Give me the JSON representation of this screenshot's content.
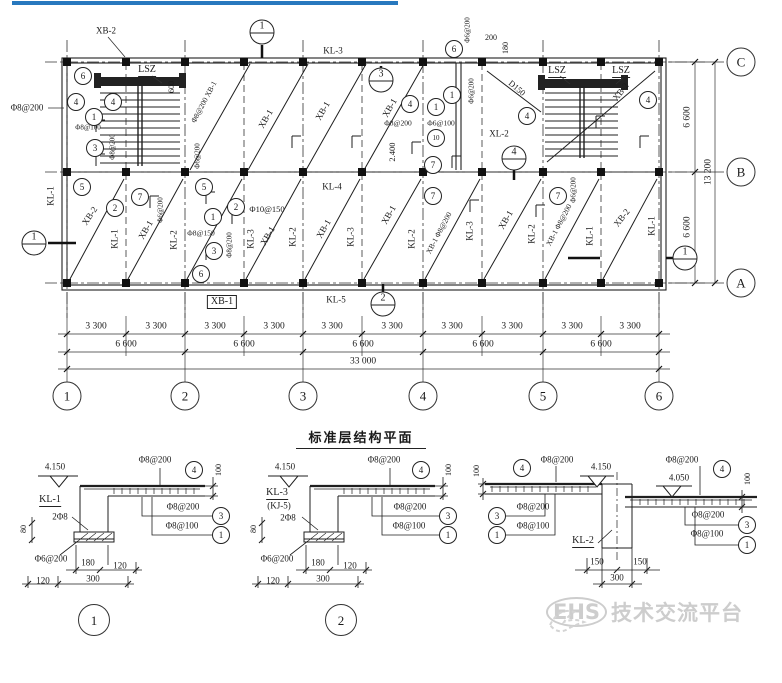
{
  "page": {
    "accent_bar_color": "#2878be",
    "background": "#ffffff"
  },
  "title": {
    "text": "标准层结构平面"
  },
  "watermark": {
    "icon": "dove-icon",
    "brand": "EHS",
    "text": "技术交流平台"
  },
  "labels": [
    {
      "t": "XB-2",
      "x": 106,
      "y": 31
    },
    {
      "t": "KL-3",
      "x": 333,
      "y": 51
    },
    {
      "t": "LSZ",
      "x": 147,
      "y": 71,
      "k": "u"
    },
    {
      "t": "600",
      "x": 172,
      "y": 87,
      "k": "v",
      "fs": 8
    },
    {
      "t": "Φ8@200",
      "x": 27,
      "y": 108
    },
    {
      "t": "Φ8@100",
      "x": 88,
      "y": 128,
      "fs": 7
    },
    {
      "t": "Φ8@200",
      "x": 113,
      "y": 147,
      "k": "v",
      "fs": 7
    },
    {
      "t": "Φ8@200 XB-1",
      "x": 204,
      "y": 102,
      "r": -62,
      "fs": 7.5
    },
    {
      "t": "Φ6@200",
      "x": 198,
      "y": 156,
      "k": "v",
      "fs": 7
    },
    {
      "t": "XB-1",
      "x": 266,
      "y": 119,
      "r": -60
    },
    {
      "t": "XB-1",
      "x": 323,
      "y": 111,
      "r": -60
    },
    {
      "t": "XB-1",
      "x": 390,
      "y": 108,
      "r": -60
    },
    {
      "t": "Φ6@200",
      "x": 468,
      "y": 30,
      "k": "v",
      "fs": 7
    },
    {
      "t": "200",
      "x": 491,
      "y": 38,
      "fs": 8
    },
    {
      "t": "180",
      "x": 506,
      "y": 48,
      "k": "v",
      "fs": 8
    },
    {
      "t": "Φ6@200",
      "x": 472,
      "y": 91,
      "k": "v",
      "fs": 7
    },
    {
      "t": "D150",
      "x": 517,
      "y": 88,
      "r": 40,
      "fs": 8.5
    },
    {
      "t": "LSZ",
      "x": 557,
      "y": 72,
      "k": "u"
    },
    {
      "t": "LSZ",
      "x": 621,
      "y": 72,
      "k": "u"
    },
    {
      "t": "XB-2",
      "x": 621,
      "y": 92,
      "r": -52
    },
    {
      "t": "Φ8@200",
      "x": 398,
      "y": 123,
      "fs": 7.5
    },
    {
      "t": "Φ6@100",
      "x": 441,
      "y": 123,
      "fs": 7.5
    },
    {
      "t": "XL-2",
      "x": 499,
      "y": 134
    },
    {
      "t": "2.400",
      "x": 392,
      "y": 152,
      "k": "v",
      "fs": 8.5
    },
    {
      "t": "KL-4",
      "x": 332,
      "y": 187
    },
    {
      "t": "KL-1",
      "x": 51,
      "y": 196,
      "k": "v"
    },
    {
      "t": "XB-2",
      "x": 90,
      "y": 216,
      "r": -56
    },
    {
      "t": "KL-1",
      "x": 115,
      "y": 239,
      "k": "v"
    },
    {
      "t": "XB-1",
      "x": 146,
      "y": 230,
      "r": -60
    },
    {
      "t": "Φ6@200",
      "x": 161,
      "y": 210,
      "k": "v",
      "fs": 7
    },
    {
      "t": "KL-2",
      "x": 174,
      "y": 240,
      "k": "v"
    },
    {
      "t": "Φ8@150",
      "x": 201,
      "y": 233,
      "fs": 7.5
    },
    {
      "t": "Φ8@200",
      "x": 230,
      "y": 245,
      "k": "v",
      "fs": 7
    },
    {
      "t": "Φ10@150",
      "x": 267,
      "y": 209,
      "fs": 8.5
    },
    {
      "t": "KL-3",
      "x": 251,
      "y": 239,
      "k": "v"
    },
    {
      "t": "XB-1",
      "x": 268,
      "y": 236,
      "r": -60
    },
    {
      "t": "KL-2",
      "x": 293,
      "y": 237,
      "k": "v"
    },
    {
      "t": "XB-1",
      "x": 324,
      "y": 229,
      "r": -60
    },
    {
      "t": "KL-3",
      "x": 351,
      "y": 237,
      "k": "v"
    },
    {
      "t": "XB-1",
      "x": 389,
      "y": 215,
      "r": -60
    },
    {
      "t": "KL-2",
      "x": 412,
      "y": 239,
      "k": "v"
    },
    {
      "t": "XB-1 Φ8@200",
      "x": 439,
      "y": 233,
      "r": -62,
      "fs": 7.5
    },
    {
      "t": "KL-3",
      "x": 470,
      "y": 231,
      "k": "v"
    },
    {
      "t": "XB-1",
      "x": 506,
      "y": 220,
      "r": -60
    },
    {
      "t": "KL-2",
      "x": 532,
      "y": 234,
      "k": "v"
    },
    {
      "t": "XB-1 Φ8@200",
      "x": 559,
      "y": 225,
      "r": -62,
      "fs": 7.5
    },
    {
      "t": "Φ6@200",
      "x": 574,
      "y": 190,
      "k": "v",
      "fs": 7
    },
    {
      "t": "KL-1",
      "x": 590,
      "y": 236,
      "k": "v"
    },
    {
      "t": "XB-2",
      "x": 622,
      "y": 218,
      "r": -52
    },
    {
      "t": "KL-1",
      "x": 652,
      "y": 226,
      "k": "v"
    },
    {
      "t": "KL-5",
      "x": 336,
      "y": 300
    },
    {
      "t": "XB-1",
      "x": 222,
      "y": 302,
      "k": "b"
    },
    {
      "t": "6",
      "x": 83,
      "y": 76,
      "k": "c"
    },
    {
      "t": "4",
      "x": 76,
      "y": 102,
      "k": "c"
    },
    {
      "t": "4",
      "x": 113,
      "y": 102,
      "k": "c"
    },
    {
      "t": "1",
      "x": 94,
      "y": 117,
      "k": "c"
    },
    {
      "t": "3",
      "x": 95,
      "y": 148,
      "k": "c"
    },
    {
      "t": "5",
      "x": 82,
      "y": 187,
      "k": "c"
    },
    {
      "t": "7",
      "x": 140,
      "y": 197,
      "k": "c"
    },
    {
      "t": "2",
      "x": 115,
      "y": 208,
      "k": "c"
    },
    {
      "t": "5",
      "x": 204,
      "y": 187,
      "k": "c"
    },
    {
      "t": "1",
      "x": 213,
      "y": 217,
      "k": "c"
    },
    {
      "t": "2",
      "x": 236,
      "y": 207,
      "k": "c"
    },
    {
      "t": "3",
      "x": 214,
      "y": 251,
      "k": "c"
    },
    {
      "t": "6",
      "x": 201,
      "y": 274,
      "k": "c"
    },
    {
      "t": "7",
      "x": 433,
      "y": 165,
      "k": "c"
    },
    {
      "t": "7",
      "x": 433,
      "y": 196,
      "k": "c"
    },
    {
      "t": "4",
      "x": 410,
      "y": 104,
      "k": "c"
    },
    {
      "t": "1",
      "x": 436,
      "y": 107,
      "k": "c"
    },
    {
      "t": "10",
      "x": 436,
      "y": 138,
      "k": "c",
      "fs": 7
    },
    {
      "t": "6",
      "x": 454,
      "y": 49,
      "k": "c"
    },
    {
      "t": "1",
      "x": 452,
      "y": 95,
      "k": "c"
    },
    {
      "t": "4",
      "x": 527,
      "y": 116,
      "k": "c"
    },
    {
      "t": "4",
      "x": 648,
      "y": 100,
      "k": "c"
    },
    {
      "t": "7",
      "x": 558,
      "y": 196,
      "k": "c"
    },
    {
      "t": "1",
      "x": 262,
      "y": 32,
      "k": "s"
    },
    {
      "t": "3",
      "x": 381,
      "y": 80,
      "k": "s"
    },
    {
      "t": "4",
      "x": 514,
      "y": 158,
      "k": "s"
    },
    {
      "t": "2",
      "x": 383,
      "y": 304,
      "k": "s"
    },
    {
      "t": "1",
      "x": 34,
      "y": 243,
      "k": "s"
    },
    {
      "t": "1",
      "x": 685,
      "y": 258,
      "k": "s"
    },
    {
      "t": "3 300",
      "x": 96,
      "y": 327,
      "fs": 9.5
    },
    {
      "t": "3 300",
      "x": 156,
      "y": 327,
      "fs": 9.5
    },
    {
      "t": "3 300",
      "x": 215,
      "y": 327,
      "fs": 9.5
    },
    {
      "t": "3 300",
      "x": 274,
      "y": 327,
      "fs": 9.5
    },
    {
      "t": "3 300",
      "x": 332,
      "y": 327,
      "fs": 9.5
    },
    {
      "t": "3 300",
      "x": 392,
      "y": 327,
      "fs": 9.5
    },
    {
      "t": "3 300",
      "x": 452,
      "y": 327,
      "fs": 9.5
    },
    {
      "t": "3 300",
      "x": 512,
      "y": 327,
      "fs": 9.5
    },
    {
      "t": "3 300",
      "x": 572,
      "y": 327,
      "fs": 9.5
    },
    {
      "t": "3 300",
      "x": 630,
      "y": 327,
      "fs": 9.5
    },
    {
      "t": "6 600",
      "x": 126,
      "y": 345,
      "fs": 9.5
    },
    {
      "t": "6 600",
      "x": 244,
      "y": 345,
      "fs": 9.5
    },
    {
      "t": "6 600",
      "x": 363,
      "y": 345,
      "fs": 9.5
    },
    {
      "t": "6 600",
      "x": 483,
      "y": 345,
      "fs": 9.5
    },
    {
      "t": "6 600",
      "x": 601,
      "y": 345,
      "fs": 9.5
    },
    {
      "t": "33 000",
      "x": 363,
      "y": 362,
      "fs": 9.5
    },
    {
      "t": "6 600",
      "x": 688,
      "y": 117,
      "k": "v",
      "fs": 9.5
    },
    {
      "t": "13 200",
      "x": 709,
      "y": 172,
      "k": "v",
      "fs": 9.5
    },
    {
      "t": "6 600",
      "x": 688,
      "y": 227,
      "k": "v",
      "fs": 9.5
    },
    {
      "t": "1",
      "x": 67,
      "y": 396,
      "k": "C"
    },
    {
      "t": "2",
      "x": 185,
      "y": 396,
      "k": "C"
    },
    {
      "t": "3",
      "x": 303,
      "y": 396,
      "k": "C"
    },
    {
      "t": "4",
      "x": 423,
      "y": 396,
      "k": "C"
    },
    {
      "t": "5",
      "x": 543,
      "y": 396,
      "k": "C"
    },
    {
      "t": "6",
      "x": 659,
      "y": 396,
      "k": "C"
    },
    {
      "t": "C",
      "x": 741,
      "y": 62,
      "k": "C"
    },
    {
      "t": "B",
      "x": 741,
      "y": 172,
      "k": "C"
    },
    {
      "t": "A",
      "x": 741,
      "y": 283,
      "k": "C"
    },
    {
      "t": "4.150",
      "x": 55,
      "y": 467,
      "fs": 9
    },
    {
      "t": "Φ8@200",
      "x": 155,
      "y": 460,
      "fs": 9
    },
    {
      "t": "4",
      "x": 194,
      "y": 470,
      "k": "c"
    },
    {
      "t": "100",
      "x": 219,
      "y": 470,
      "k": "v",
      "fs": 8
    },
    {
      "t": "KL-1",
      "x": 50,
      "y": 501,
      "k": "u"
    },
    {
      "t": "2Φ8",
      "x": 60,
      "y": 517,
      "fs": 9
    },
    {
      "t": "Φ8@200",
      "x": 183,
      "y": 507,
      "fs": 9
    },
    {
      "t": "3",
      "x": 221,
      "y": 516,
      "k": "c"
    },
    {
      "t": "Φ8@100",
      "x": 182,
      "y": 526,
      "fs": 9
    },
    {
      "t": "1",
      "x": 221,
      "y": 535,
      "k": "c"
    },
    {
      "t": "80",
      "x": 24,
      "y": 529,
      "k": "v",
      "fs": 8
    },
    {
      "t": "Φ6@200",
      "x": 51,
      "y": 559,
      "fs": 9
    },
    {
      "t": "180",
      "x": 88,
      "y": 563,
      "fs": 9
    },
    {
      "t": "120",
      "x": 120,
      "y": 566,
      "fs": 9
    },
    {
      "t": "120",
      "x": 43,
      "y": 581,
      "fs": 9
    },
    {
      "t": "300",
      "x": 93,
      "y": 579,
      "fs": 9
    },
    {
      "t": "1",
      "x": 94,
      "y": 620,
      "k": "D"
    },
    {
      "t": "4.150",
      "x": 285,
      "y": 467,
      "fs": 9
    },
    {
      "t": "Φ8@200",
      "x": 384,
      "y": 460,
      "fs": 9
    },
    {
      "t": "4",
      "x": 421,
      "y": 470,
      "k": "c"
    },
    {
      "t": "100",
      "x": 449,
      "y": 470,
      "k": "v",
      "fs": 8
    },
    {
      "t": "KL-3",
      "x": 277,
      "y": 494,
      "k": "u"
    },
    {
      "t": "(KJ-5)",
      "x": 279,
      "y": 506,
      "fs": 9
    },
    {
      "t": "2Φ8",
      "x": 288,
      "y": 518,
      "fs": 9
    },
    {
      "t": "Φ8@200",
      "x": 410,
      "y": 507,
      "fs": 9
    },
    {
      "t": "3",
      "x": 448,
      "y": 516,
      "k": "c"
    },
    {
      "t": "Φ8@100",
      "x": 409,
      "y": 526,
      "fs": 9
    },
    {
      "t": "1",
      "x": 448,
      "y": 535,
      "k": "c"
    },
    {
      "t": "80",
      "x": 254,
      "y": 529,
      "k": "v",
      "fs": 8
    },
    {
      "t": "Φ6@200",
      "x": 277,
      "y": 559,
      "fs": 9
    },
    {
      "t": "180",
      "x": 318,
      "y": 563,
      "fs": 9
    },
    {
      "t": "120",
      "x": 350,
      "y": 566,
      "fs": 9
    },
    {
      "t": "120",
      "x": 273,
      "y": 581,
      "fs": 9
    },
    {
      "t": "300",
      "x": 323,
      "y": 579,
      "fs": 9
    },
    {
      "t": "2",
      "x": 341,
      "y": 620,
      "k": "D"
    },
    {
      "t": "4",
      "x": 522,
      "y": 468,
      "k": "c"
    },
    {
      "t": "Φ8@200",
      "x": 557,
      "y": 460,
      "fs": 9
    },
    {
      "t": "4.150",
      "x": 601,
      "y": 467,
      "fs": 9
    },
    {
      "t": "100",
      "x": 477,
      "y": 471,
      "k": "v",
      "fs": 8
    },
    {
      "t": "3",
      "x": 497,
      "y": 516,
      "k": "c"
    },
    {
      "t": "Φ8@200",
      "x": 533,
      "y": 507,
      "fs": 9
    },
    {
      "t": "1",
      "x": 497,
      "y": 535,
      "k": "c"
    },
    {
      "t": "Φ8@100",
      "x": 533,
      "y": 526,
      "fs": 9
    },
    {
      "t": "KL-2",
      "x": 583,
      "y": 542,
      "k": "u"
    },
    {
      "t": "Φ8@200",
      "x": 682,
      "y": 460,
      "fs": 9
    },
    {
      "t": "4",
      "x": 722,
      "y": 469,
      "k": "c"
    },
    {
      "t": "4.050",
      "x": 679,
      "y": 478,
      "fs": 9
    },
    {
      "t": "100",
      "x": 748,
      "y": 479,
      "k": "v",
      "fs": 8
    },
    {
      "t": "Φ8@200",
      "x": 708,
      "y": 515,
      "fs": 9
    },
    {
      "t": "3",
      "x": 747,
      "y": 525,
      "k": "c"
    },
    {
      "t": "Φ8@100",
      "x": 707,
      "y": 534,
      "fs": 9
    },
    {
      "t": "1",
      "x": 747,
      "y": 545,
      "k": "c"
    },
    {
      "t": "150",
      "x": 597,
      "y": 562,
      "fs": 9
    },
    {
      "t": "150",
      "x": 640,
      "y": 562,
      "fs": 9
    },
    {
      "t": "300",
      "x": 617,
      "y": 578,
      "fs": 9
    }
  ]
}
